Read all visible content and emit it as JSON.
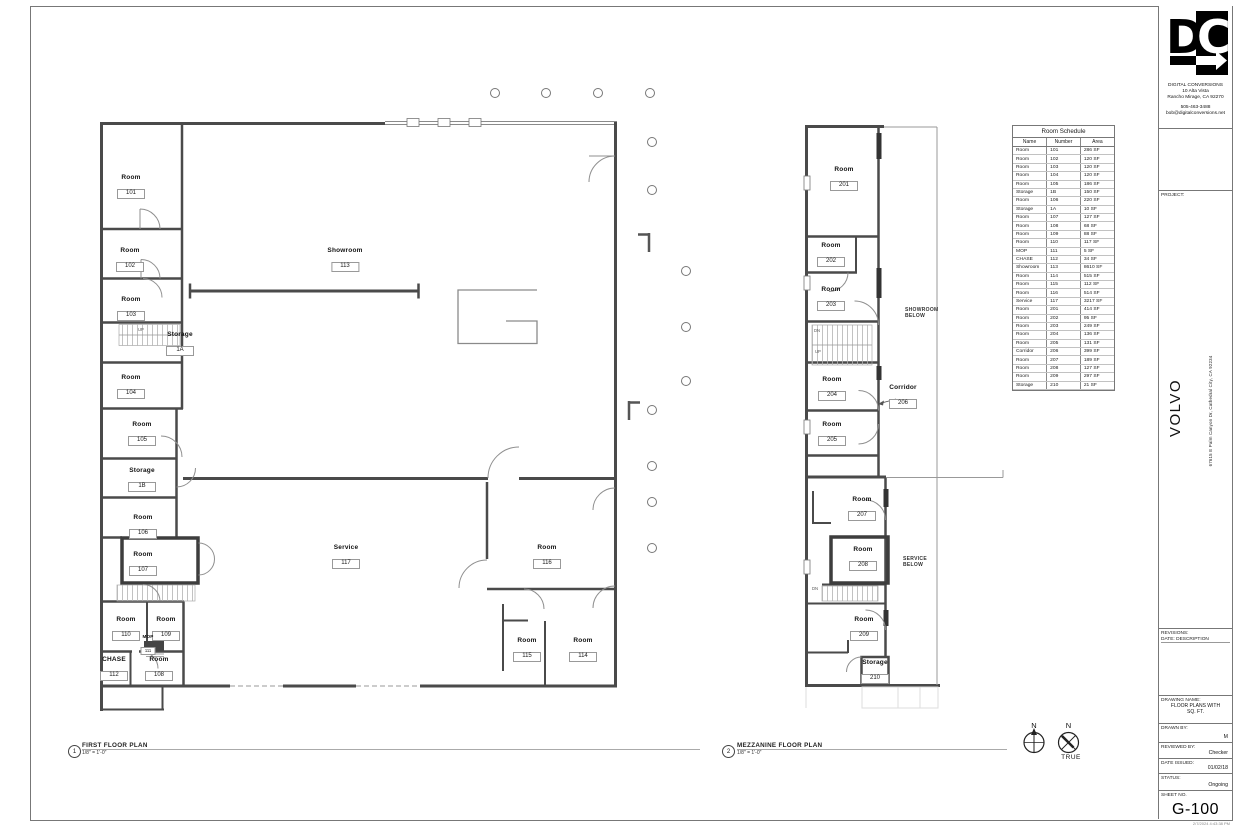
{
  "titleblock": {
    "logo_d": "D",
    "logo_c": "C",
    "company_name": "DIGITAL CONVERSIONS",
    "company_address_line1": "10 Alta Vista",
    "company_address_line2": "Rancho Mirage, CA 92270",
    "company_phone": "505-463-3488",
    "company_email": "bob@digitalconversions.net",
    "project_label": "PROJECT:",
    "project_name": "VOLVO",
    "project_address": "67615 E Palm Canyon Dr, Cathedral City, CA 92234",
    "revisions_label": "REVISIONS:",
    "revisions_columns": "DATE:  DESCRIPTION",
    "drawing_name_label": "DRAWING NAME:",
    "drawing_name_line1": "FLOOR PLANS WITH",
    "drawing_name_line2": "SQ. FT.",
    "drawn_by_label": "DRAWN BY:",
    "drawn_by": "M",
    "reviewed_by_label": "REVIEWED BY:",
    "reviewed_by": "Checker",
    "date_issued_label": "DATE ISSUED:",
    "date_issued": "01/02/18",
    "status_label": "STATUS:",
    "status": "Ongoing",
    "sheet_no_label": "SHEET NO.",
    "sheet_no": "G-100",
    "print_stamp": "2/7/2024 4:43:38 PM"
  },
  "schedule": {
    "title": "Room Schedule",
    "columns": [
      "Name",
      "Number",
      "Area"
    ],
    "rows": [
      [
        "Room",
        "101",
        "286 SF"
      ],
      [
        "Room",
        "102",
        "120 SF"
      ],
      [
        "Room",
        "103",
        "120 SF"
      ],
      [
        "Room",
        "104",
        "120 SF"
      ],
      [
        "Room",
        "105",
        "186 SF"
      ],
      [
        "Storage",
        "1B",
        "150 SF"
      ],
      [
        "Room",
        "106",
        "220 SF"
      ],
      [
        "Storage",
        "1A",
        "10 SF"
      ],
      [
        "Room",
        "107",
        "127 SF"
      ],
      [
        "Room",
        "108",
        "68 SF"
      ],
      [
        "Room",
        "109",
        "88 SF"
      ],
      [
        "Room",
        "110",
        "117 SF"
      ],
      [
        "MOP",
        "111",
        "5 SF"
      ],
      [
        "CHASE",
        "112",
        "34 SF"
      ],
      [
        "Showroom",
        "113",
        "8610 SF"
      ],
      [
        "Room",
        "114",
        "515 SF"
      ],
      [
        "Room",
        "115",
        "112 SF"
      ],
      [
        "Room",
        "116",
        "514 SF"
      ],
      [
        "Service",
        "117",
        "3217 SF"
      ],
      [
        "Room",
        "201",
        "414 SF"
      ],
      [
        "Room",
        "202",
        "95 SF"
      ],
      [
        "Room",
        "203",
        "249 SF"
      ],
      [
        "Room",
        "204",
        "136 SF"
      ],
      [
        "Room",
        "205",
        "131 SF"
      ],
      [
        "Corridor",
        "206",
        "399 SF"
      ],
      [
        "Room",
        "207",
        "189 SF"
      ],
      [
        "Room",
        "208",
        "127 SF"
      ],
      [
        "Room",
        "209",
        "297 SF"
      ],
      [
        "Storage",
        "210",
        "21 SF"
      ]
    ]
  },
  "plan_titles": {
    "first": {
      "number": "1",
      "title": "FIRST FLOOR PLAN",
      "scale": "1/8\" = 1'-0\""
    },
    "mezzanine": {
      "number": "2",
      "title": "MEZZANINE FLOOR PLAN",
      "scale": "1/8\" = 1'-0\""
    }
  },
  "north": {
    "n1": "N",
    "n2": "N",
    "true_label": "TRUE"
  },
  "rooms_ff": [
    {
      "name": "Room",
      "number": "101"
    },
    {
      "name": "Room",
      "number": "102"
    },
    {
      "name": "Room",
      "number": "103"
    },
    {
      "name": "Storage",
      "number": "1A"
    },
    {
      "name": "Room",
      "number": "104"
    },
    {
      "name": "Room",
      "number": "105"
    },
    {
      "name": "Storage",
      "number": "1B"
    },
    {
      "name": "Room",
      "number": "106"
    },
    {
      "name": "Room",
      "number": "107"
    },
    {
      "name": "Room",
      "number": "110"
    },
    {
      "name": "Room",
      "number": "109"
    },
    {
      "name": "MOP",
      "number": "111"
    },
    {
      "name": "CHASE",
      "number": "112"
    },
    {
      "name": "Room",
      "number": "108"
    },
    {
      "name": "Showroom",
      "number": "113"
    },
    {
      "name": "Service",
      "number": "117"
    },
    {
      "name": "Room",
      "number": "116"
    },
    {
      "name": "Room",
      "number": "115"
    },
    {
      "name": "Room",
      "number": "114"
    }
  ],
  "rooms_mz": [
    {
      "name": "Room",
      "number": "201"
    },
    {
      "name": "Room",
      "number": "202"
    },
    {
      "name": "Room",
      "number": "203"
    },
    {
      "name": "Room",
      "number": "204"
    },
    {
      "name": "Room",
      "number": "205"
    },
    {
      "name": "Corridor",
      "number": "206"
    },
    {
      "name": "Room",
      "number": "207"
    },
    {
      "name": "Room",
      "number": "208"
    },
    {
      "name": "Room",
      "number": "209"
    },
    {
      "name": "Storage",
      "number": "210"
    }
  ],
  "annotations": {
    "up": "UP",
    "dn": "DN",
    "showroom_below_1": "SHOWROOM",
    "showroom_below_2": "BELOW",
    "service_below_1": "SERVICE",
    "service_below_2": "BELOW"
  }
}
